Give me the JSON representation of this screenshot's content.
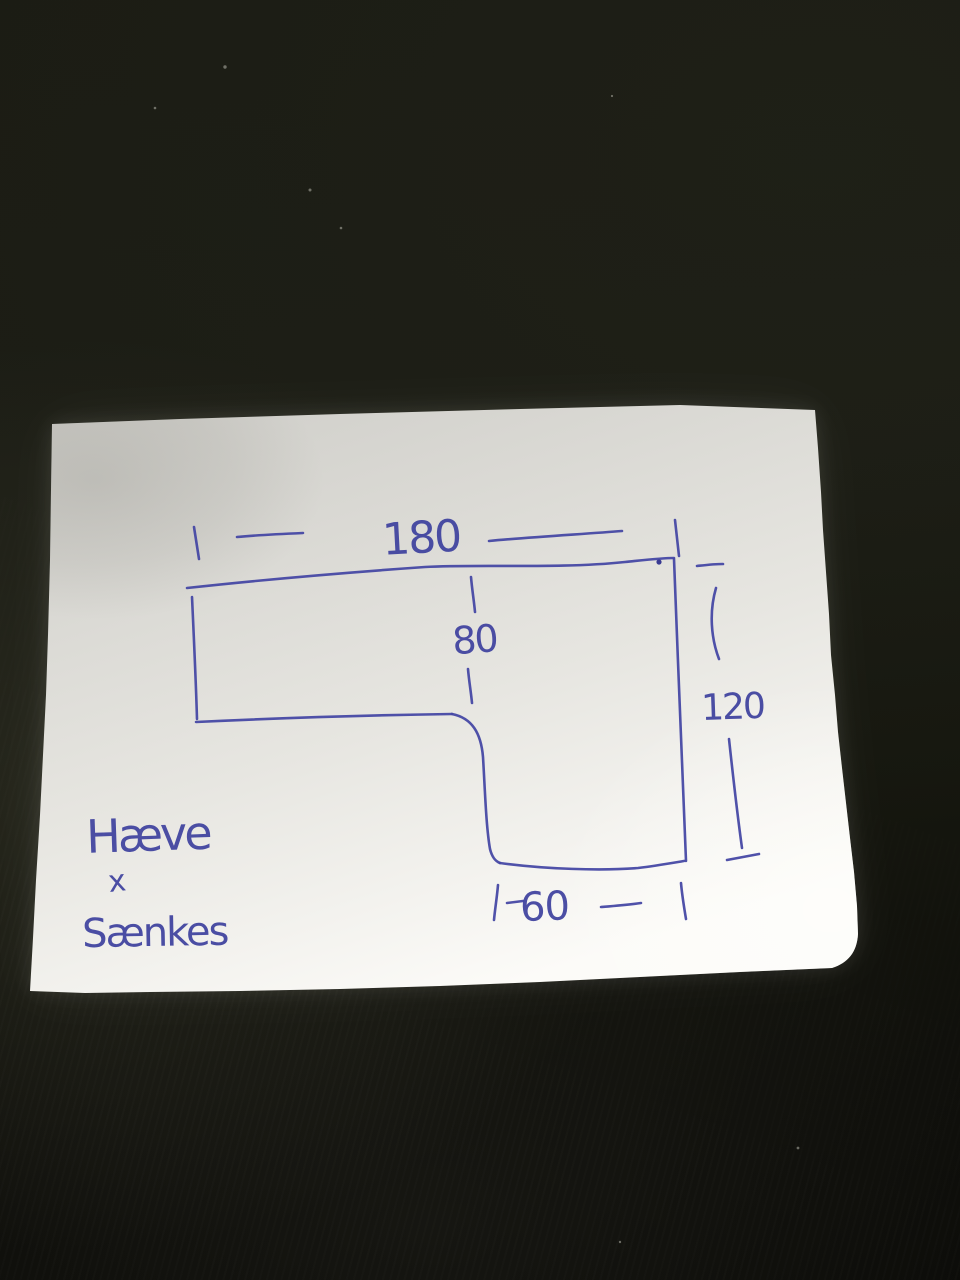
{
  "scene": {
    "background_color": "#16170f",
    "paper_color": "#e4e3de",
    "ink_color": "#4648a4"
  },
  "sketch": {
    "shape": "L-shaped desk top outline with rounded inner corner",
    "dimensions": [
      {
        "name": "top-width",
        "value": "180"
      },
      {
        "name": "inner-depth",
        "value": "80"
      },
      {
        "name": "right-height",
        "value": "120"
      },
      {
        "name": "foot-width",
        "value": "60"
      }
    ],
    "note_lines": [
      "Hæve",
      "x",
      "Sænkes"
    ]
  }
}
